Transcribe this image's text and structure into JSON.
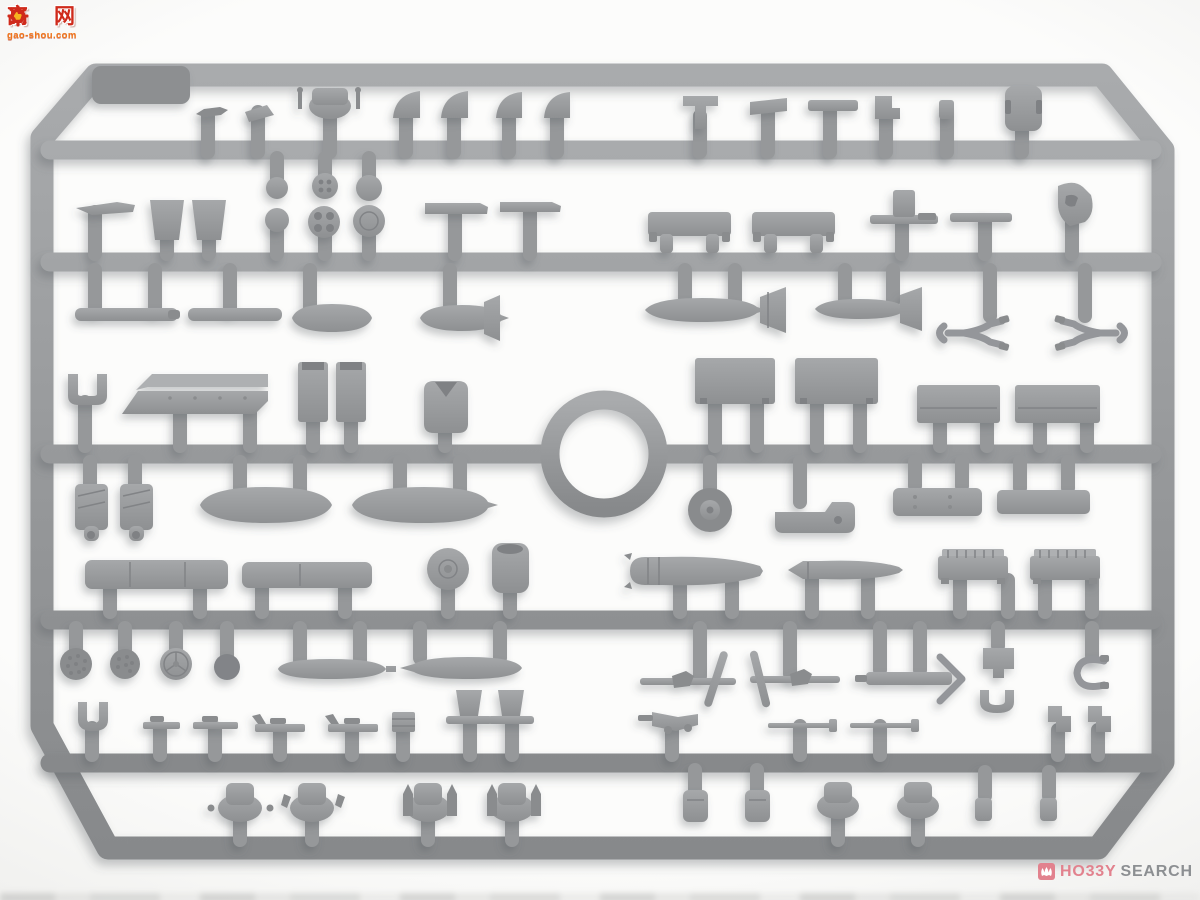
{
  "photo": {
    "subject": "Injection-molded gray plastic model kit sprue (parts tree) photographed on a light background",
    "plastic_color": "#97999b",
    "background_color": "#fbfbfa",
    "frame_shape": "rounded rectangle with chamfered corners, central vertical spine and circular ring hub"
  },
  "watermark": {
    "char_left": "高",
    "char_right": "网",
    "site": "gao-shou.com",
    "icon": "gear-thumb-icon",
    "red": "#cf2a1b",
    "orange": "#f07418"
  },
  "logo": {
    "brand_first": "HO33Y",
    "brand_second": "SEARCH",
    "icon": "hobbysearch-mark-icon",
    "pink": "#e2828e",
    "gray": "#8c8f92"
  }
}
